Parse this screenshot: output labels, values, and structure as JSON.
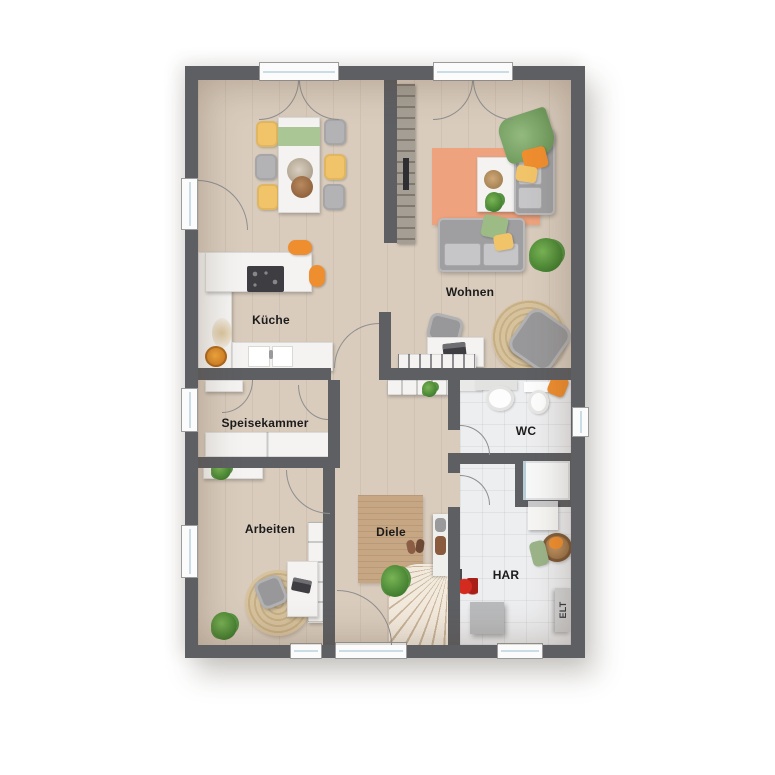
{
  "type": "floor-plan",
  "rooms": {
    "kueche": {
      "label": "Küche"
    },
    "wohnen": {
      "label": "Wohnen"
    },
    "speisekammer": {
      "label": "Speisekammer"
    },
    "arbeiten": {
      "label": "Arbeiten"
    },
    "diele": {
      "label": "Diele"
    },
    "wc": {
      "label": "WC"
    },
    "har": {
      "label": "HAR"
    },
    "elt": {
      "label": "ELT"
    }
  },
  "colors": {
    "wall": "#5e5f63",
    "floor": "#d9ccbd",
    "tile": "#edeef0",
    "white": "#f4f3f1",
    "salmon": "#eea37e",
    "dielerug": "#c7a783",
    "jute": "#d5bf9c",
    "sofa": "#9f9fa1",
    "green": "#a9c694",
    "plantgreen": "#4e9639",
    "yellow": "#f2c469",
    "orange": "#ef8e2f",
    "dark": "#3e3e42",
    "arc": "#8f8f8f",
    "text": "#1b1b1b",
    "stairs": "#ead9c2"
  }
}
